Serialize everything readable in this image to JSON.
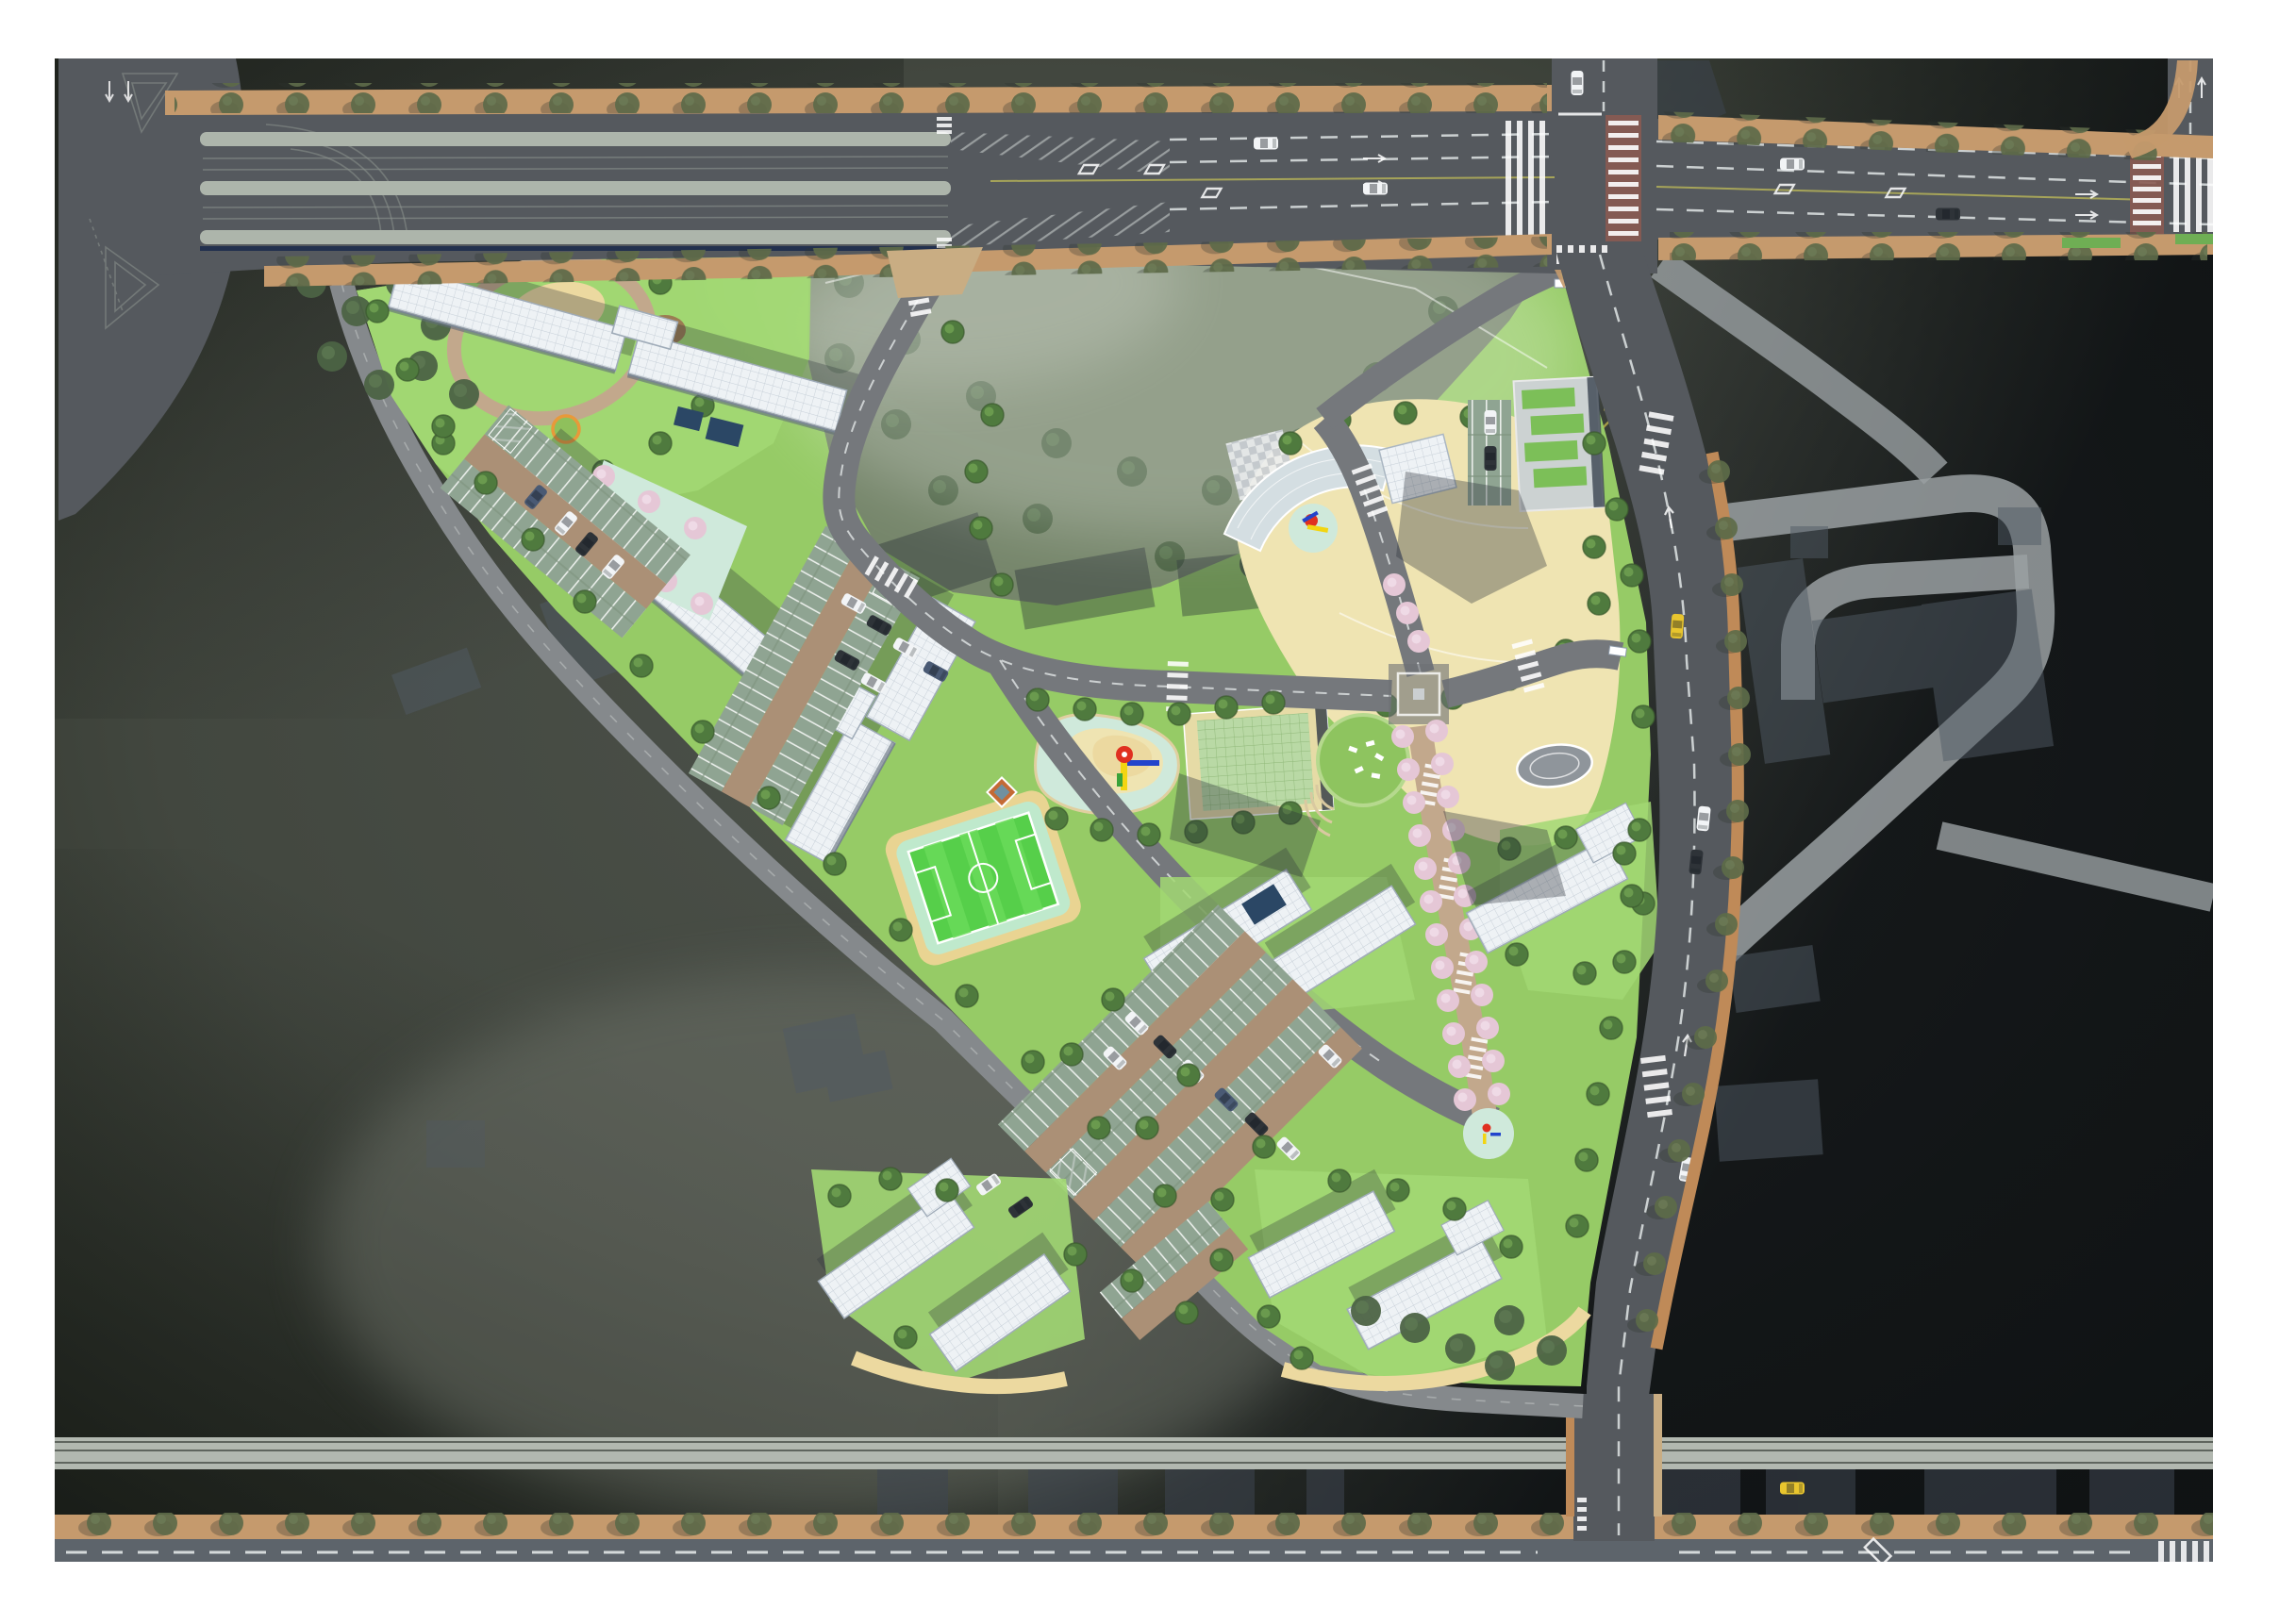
{
  "meta": {
    "kind": "architectural-master-plan-rendering",
    "view": "top-down aerial site plan",
    "visible_text": "none"
  },
  "colors": {
    "page-bg": "#ffffff",
    "backdrop": "#454a43",
    "backdrop-light": "#747970",
    "backdrop-dark": "#15181a",
    "asphalt": "#55595e",
    "asphalt-light": "#6c7074",
    "road-internal": "#75787c",
    "bound-road": "#85898c",
    "median": "#adb5ab",
    "median-line": "#8e9590",
    "navy-strip": "#22304e",
    "lane-white": "#e9eded",
    "lane-yellow": "#c9c557",
    "sidewalk": "#c59a6d",
    "sidewalk-east": "#bf8a58",
    "apron": "#c9ad83",
    "street-tree": "#5d6b49",
    "street-tree-dark": "#394230",
    "canal": "#b2b8b0",
    "canal-line": "#5f655e",
    "crosswalk-red": "#8a5a52",
    "verge-green": "#6fae54",
    "site-lawn": "#96cb66",
    "lawn-bright": "#a2d873",
    "lawn-dark": "#58954a",
    "park-olive": "#76866b",
    "park-tree": "#4c6344",
    "woods": "#3f5c38",
    "tree-green": "#4f7a3e",
    "tree-light": "#70a253",
    "path-brick": "#c2a88c",
    "sand": "#ecd9a0",
    "dirt": "#9b7c52",
    "roof-white": "#eef2f5",
    "roof-grid": "#c6cfd8",
    "roof-edge": "#8c99a8",
    "bldg-shadow": "#2b3139",
    "mint": "#cfe9db",
    "cream": "#f2e5bd",
    "plaza-cream": "#efe4b2",
    "oval-gray": "#8f959b",
    "blossom": "#e5c7d6",
    "blossom-light": "#f0dce8",
    "stall-green": "#8fa492",
    "aisle-tan": "#ab9076",
    "field-green": "#56cf4a",
    "field-stripe": "#6adb5a",
    "field-ring": "#bfe9cc",
    "field-edge": "#e9d492",
    "green-roof": "#b9d9a5",
    "green-roof-line": "#8fb878",
    "green-roof-edge": "#e6dba6",
    "glass-dark": "#2b4765",
    "glass-arc": "#d4dee2",
    "ghost-road": "#9aa0a2",
    "ghost-bldg": "#515a64",
    "hill-green": "#8ec45f",
    "play-red": "#e03020",
    "play-yellow": "#f2d512",
    "play-blue": "#2244cc",
    "car-white": "#f2f4f6",
    "car-dark": "#2e3338",
    "car-blue": "#4a5a74",
    "car-yellow": "#e8c52e"
  },
  "regions": [
    {
      "name": "top-arterial-road",
      "desc": "multi-lane east-west arterial with striped medians, merge hatching, lane diamonds and tree-lined sidewalks"
    },
    {
      "name": "top-right-signal-intersection",
      "desc": "crossroad with zebra and red-brick crosswalks"
    },
    {
      "name": "far-right-intersection",
      "desc": "second crossroad at right image edge"
    },
    {
      "name": "east-boundary-road",
      "desc": "north-south road along east edge of site with brick sidewalk and street trees"
    },
    {
      "name": "southwest-boundary-road",
      "desc": "diagonal perimeter road along southwest site edge"
    },
    {
      "name": "bottom-road",
      "desc": "east-west road at bottom with tree-lined sidewalk and T junction connector"
    },
    {
      "name": "canal-band",
      "desc": "light wall/canal strip spanning full width above bottom road"
    },
    {
      "name": "preserved-park",
      "desc": "misty preserved woodland in north part of triangular site"
    },
    {
      "name": "northwest-pocket-park",
      "desc": "corner park with loop path, sand play area and lawn"
    },
    {
      "name": "west-residential-cluster",
      "desc": "two zigzag slab buildings, mint courtyard with blossom trees, surface parking"
    },
    {
      "name": "central-residential-cluster",
      "desc": "white gridded roof slabs with parking rows"
    },
    {
      "name": "soccer-field",
      "desc": "bright green mini pitch with white markings and mint ring"
    },
    {
      "name": "central-playground",
      "desc": "organic pastel play surface with red-capped play tower"
    },
    {
      "name": "community-green-roof-building",
      "desc": "large pale-green gridded roof hall with round lawn hill and deck chairs"
    },
    {
      "name": "kindergarten-arc-building",
      "desc": "curved glazed roof building at northeast entrance"
    },
    {
      "name": "central-plaza",
      "desc": "cream paved boulevard with oval motif and round trees"
    },
    {
      "name": "blossom-avenue",
      "desc": "north-south pedestrian spine with double row of pink blossom trees"
    },
    {
      "name": "southeast-residential-cluster",
      "desc": "white slabs on lawns east of blossom avenue"
    },
    {
      "name": "south-parking-field",
      "desc": "large diagonal parking rows with sage stall roofs and cars"
    },
    {
      "name": "south-residential-clusters",
      "desc": "two building groups with lawns and sandy paths at south tip"
    },
    {
      "name": "ghost-development",
      "desc": "semi-transparent future road loop and building footprints on right"
    },
    {
      "name": "ghost-context-buildings",
      "desc": "faded existing building footprints west of site and below canal"
    }
  ]
}
